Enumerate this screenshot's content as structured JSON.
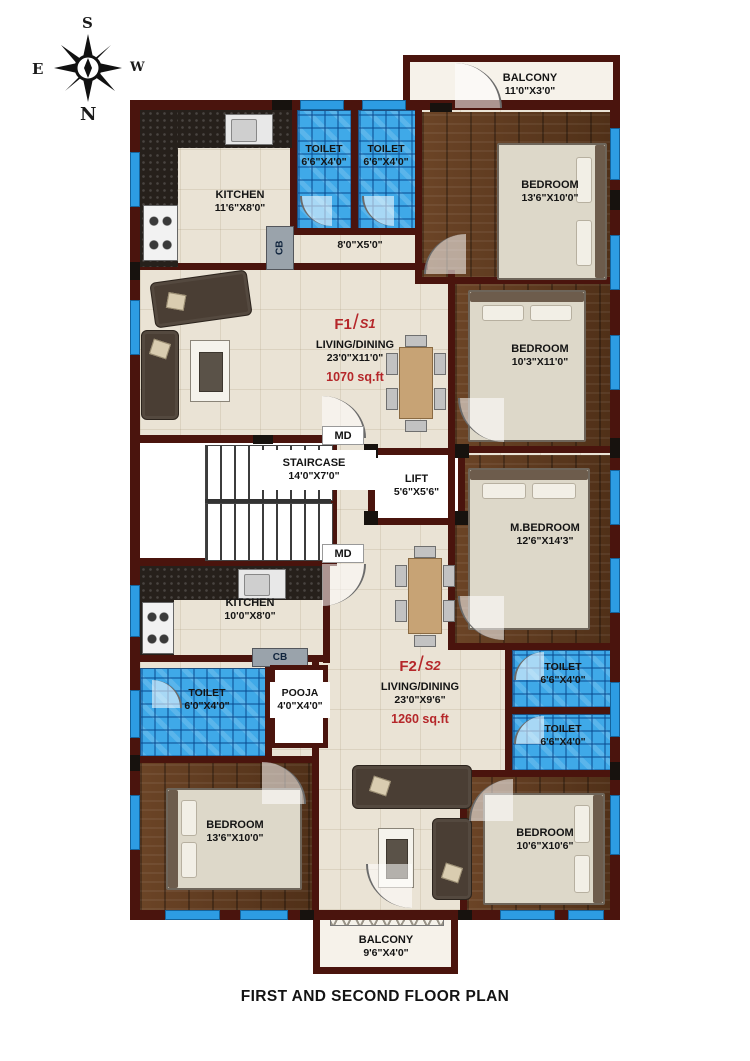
{
  "compass": {
    "top": "S",
    "right": "W",
    "bottom": "N",
    "left": "E"
  },
  "title": "FIRST AND SECOND FLOOR PLAN",
  "labels": {
    "md": "MD",
    "cb": "CB"
  },
  "colors": {
    "wall": "#4a140d",
    "accent_red": "#b5272a",
    "window_blue": "#2d9ce3",
    "tile_blue": "#3fa9e8",
    "wood": "#5f3a1f",
    "floor_cream": "#eae3d5"
  },
  "units": {
    "f1": {
      "unit_a": "F1",
      "sep": "/",
      "unit_b": "S1",
      "name": "LIVING/DINING",
      "dims": "23'0\"X11'0\"",
      "area": "1070 sq.ft"
    },
    "f2": {
      "unit_a": "F2",
      "sep": "/",
      "unit_b": "S2",
      "name": "LIVING/DINING",
      "dims": "23'0\"X9'6\"",
      "area": "1260 sq.ft"
    }
  },
  "rooms": {
    "balcony_top": {
      "name": "BALCONY",
      "dims": "11'0\"X3'0\""
    },
    "toilet_top_1": {
      "name": "TOILET",
      "dims": "6'6\"X4'0\""
    },
    "toilet_top_2": {
      "name": "TOILET",
      "dims": "6'6\"X4'0\""
    },
    "kitchen_f1": {
      "name": "KITCHEN",
      "dims": "11'6\"X8'0\""
    },
    "passage_f1": {
      "dims": "8'0\"X5'0\""
    },
    "bedroom_1": {
      "name": "BEDROOM",
      "dims": "13'6\"X10'0\""
    },
    "bedroom_2": {
      "name": "BEDROOM",
      "dims": "10'3\"X11'0\""
    },
    "staircase": {
      "name": "STAIRCASE",
      "dims": "14'0\"X7'0\""
    },
    "lift": {
      "name": "LIFT",
      "dims": "5'6\"X5'6\""
    },
    "m_bedroom": {
      "name": "M.BEDROOM",
      "dims": "12'6\"X14'3\""
    },
    "kitchen_f2": {
      "name": "KITCHEN",
      "dims": "10'0\"X8'0\""
    },
    "toilet_f2": {
      "name": "TOILET",
      "dims": "6'0\"X4'0\""
    },
    "pooja": {
      "name": "POOJA",
      "dims": "4'0\"X4'0\""
    },
    "toilet_r1": {
      "name": "TOILET",
      "dims": "6'6\"X4'0\""
    },
    "toilet_r2": {
      "name": "TOILET",
      "dims": "6'6\"X4'0\""
    },
    "bedroom_3": {
      "name": "BEDROOM",
      "dims": "13'6\"X10'0\""
    },
    "bedroom_4": {
      "name": "BEDROOM",
      "dims": "10'6\"X10'6\""
    },
    "balcony_bottom": {
      "name": "BALCONY",
      "dims": "9'6\"X4'0\""
    }
  }
}
